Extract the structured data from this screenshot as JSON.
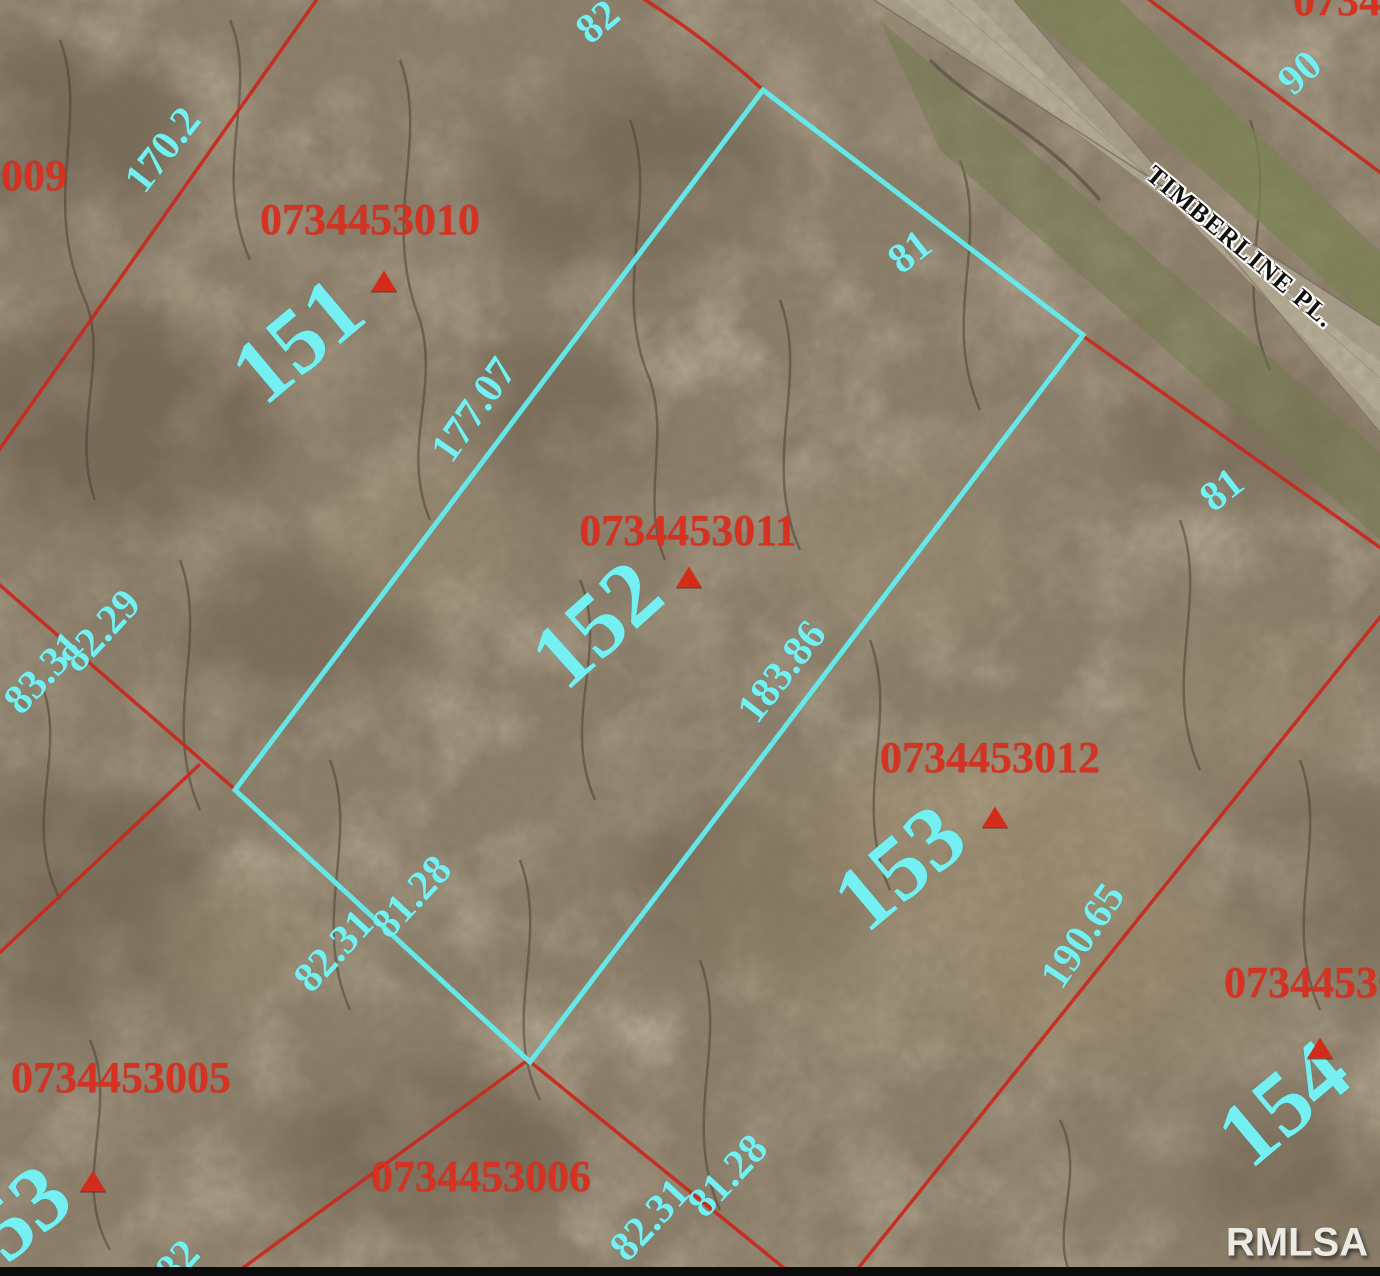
{
  "map": {
    "street_label": "TIMBERLINE PL.",
    "watermark": "RMLSA",
    "colors": {
      "parcel_line": "#c9281c",
      "highlight_outline": "#63edef",
      "label_cyan": "#74f0f2",
      "parcel_id_red": "#d53222",
      "marker_red": "#d42c1a",
      "road_fill": "#b3aa94",
      "grass_fill": "#7b8850"
    },
    "highlighted_parcel": {
      "lot": "152",
      "parcel_id": "0734453011",
      "outline_points": "763,90 1083,335 530,1062 235,790"
    },
    "lot_numbers": [
      {
        "text": "151",
        "x": 297,
        "y": 340,
        "rot": -40
      },
      {
        "text": "152",
        "x": 596,
        "y": 624,
        "rot": -42
      },
      {
        "text": "153",
        "x": 899,
        "y": 867,
        "rot": -40
      },
      {
        "text": "154",
        "x": 1283,
        "y": 1103,
        "rot": -40
      },
      {
        "text": "53",
        "x": 22,
        "y": 1212,
        "rot": -40
      }
    ],
    "parcel_ids": [
      {
        "text": "0734453010",
        "x": 370,
        "y": 220
      },
      {
        "text": "0734453011",
        "x": 688,
        "y": 531
      },
      {
        "text": "0734453012",
        "x": 990,
        "y": 758
      },
      {
        "text": "0734453005",
        "x": 121,
        "y": 1078
      },
      {
        "text": "0734453006",
        "x": 481,
        "y": 1177
      },
      {
        "text": "07344530",
        "x": 1312,
        "y": 983
      },
      {
        "text": "3009",
        "x": 23,
        "y": 176
      },
      {
        "text": "07344",
        "x": 1348,
        "y": 1
      }
    ],
    "dimension_labels": [
      {
        "text": "170.2",
        "x": 163,
        "y": 150,
        "rot": -52
      },
      {
        "text": "82",
        "x": 598,
        "y": 22,
        "rot": -40
      },
      {
        "text": "90",
        "x": 1300,
        "y": 73,
        "rot": -42
      },
      {
        "text": "81",
        "x": 910,
        "y": 252,
        "rot": -38
      },
      {
        "text": "177.07",
        "x": 474,
        "y": 410,
        "rot": -55
      },
      {
        "text": "183.86",
        "x": 782,
        "y": 672,
        "rot": -52
      },
      {
        "text": "82.29",
        "x": 101,
        "y": 631,
        "rot": -47
      },
      {
        "text": "83.31",
        "x": 44,
        "y": 673,
        "rot": -47
      },
      {
        "text": "81.28",
        "x": 412,
        "y": 897,
        "rot": -47
      },
      {
        "text": "82.31",
        "x": 334,
        "y": 951,
        "rot": -47
      },
      {
        "text": "81",
        "x": 1222,
        "y": 490,
        "rot": -38
      },
      {
        "text": "190.65",
        "x": 1083,
        "y": 936,
        "rot": -56
      },
      {
        "text": "82.31",
        "x": 650,
        "y": 1220,
        "rot": -47
      },
      {
        "text": "81.28",
        "x": 728,
        "y": 1176,
        "rot": -47
      },
      {
        "text": "82",
        "x": 178,
        "y": 1262,
        "rot": -47
      }
    ],
    "markers": [
      {
        "x": 384,
        "y": 281
      },
      {
        "x": 689,
        "y": 577
      },
      {
        "x": 995,
        "y": 817
      },
      {
        "x": 1320,
        "y": 1048
      },
      {
        "x": 93,
        "y": 1181
      }
    ]
  }
}
